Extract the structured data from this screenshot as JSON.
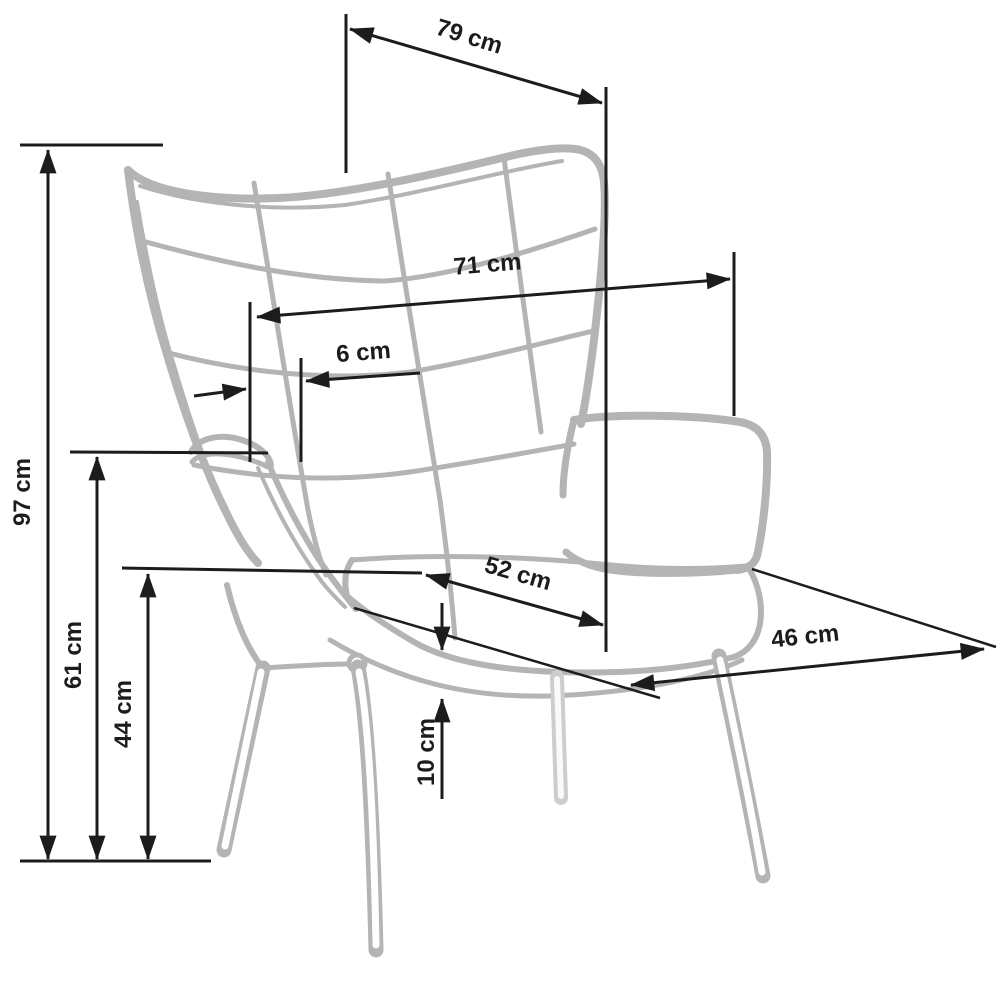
{
  "diagram": {
    "subject": "wingback armchair technical dimension drawing",
    "unit": "cm",
    "colors": {
      "sketch_gray": "#b4b4b4",
      "sketch_light_gray": "#cdcdcd",
      "dimension_black": "#1c1c1c",
      "background": "#ffffff"
    },
    "dimensions": {
      "total_depth": {
        "label": "79 cm",
        "value": 79
      },
      "total_width": {
        "label": "71 cm",
        "value": 71
      },
      "wing_offset": {
        "label": "6 cm",
        "value": 6
      },
      "total_height": {
        "label": "97 cm",
        "value": 97
      },
      "armrest_height": {
        "label": "61 cm",
        "value": 61
      },
      "seat_height": {
        "label": "44 cm",
        "value": 44
      },
      "seat_depth": {
        "label": "52 cm",
        "value": 52
      },
      "cushion_thickness": {
        "label": "10 cm",
        "value": 10
      },
      "seat_width": {
        "label": "46 cm",
        "value": 46
      }
    }
  }
}
